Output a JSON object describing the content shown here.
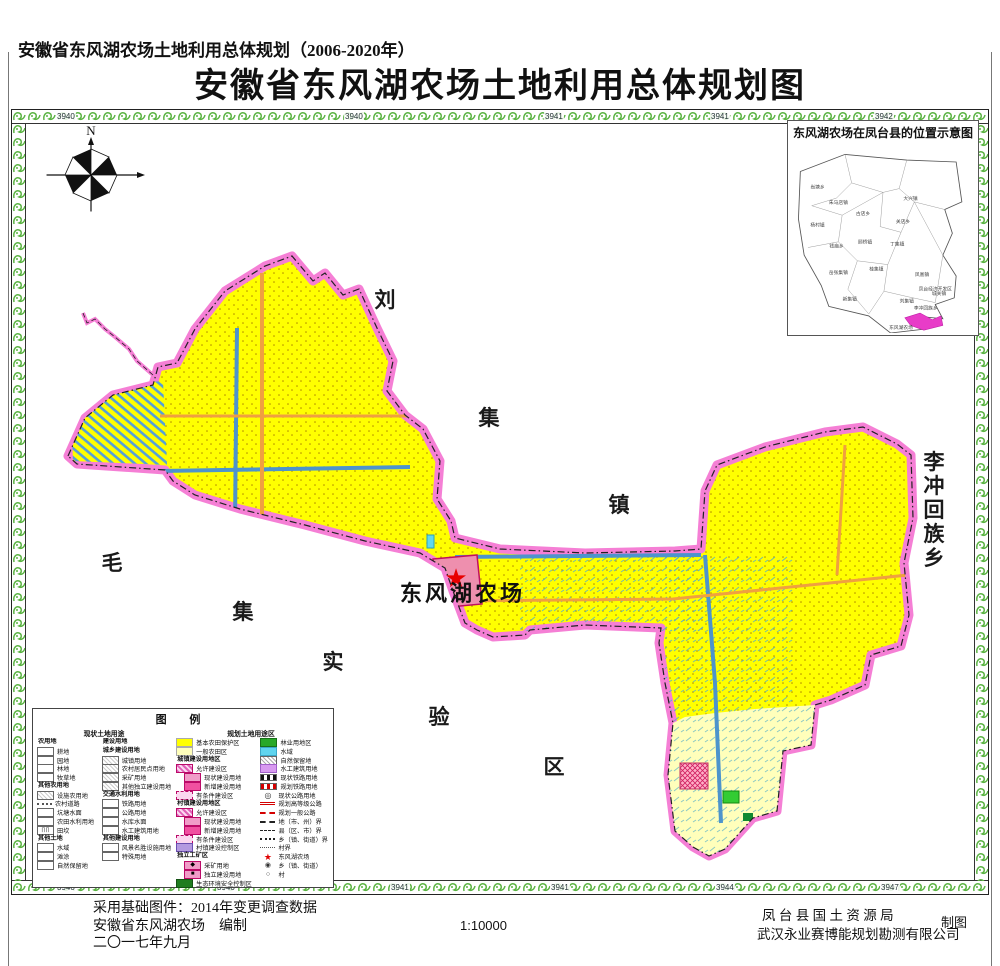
{
  "titles": {
    "subtitle": "安徽省东风湖农场土地利用总体规划（2006-2020年）",
    "title": "安徽省东风湖农场土地利用总体规划图"
  },
  "compass": {
    "north_label": "N"
  },
  "map": {
    "farm_label": "东风湖农场",
    "scatter_labels": [
      {
        "t": "刘",
        "x": 360,
        "y": 184
      },
      {
        "t": "集",
        "x": 464,
        "y": 302
      },
      {
        "t": "镇",
        "x": 594,
        "y": 389
      },
      {
        "t": "毛",
        "x": 87,
        "y": 447
      },
      {
        "t": "集",
        "x": 218,
        "y": 496
      },
      {
        "t": "实",
        "x": 308,
        "y": 546
      },
      {
        "t": "验",
        "x": 414,
        "y": 601
      },
      {
        "t": "区",
        "x": 529,
        "y": 651
      },
      {
        "t": "李",
        "x": 909,
        "y": 346,
        "s": 18
      },
      {
        "t": "冲",
        "x": 909,
        "y": 370,
        "s": 18
      },
      {
        "t": "回",
        "x": 909,
        "y": 394,
        "s": 18
      },
      {
        "t": "族",
        "x": 909,
        "y": 418,
        "s": 18
      },
      {
        "t": "乡",
        "x": 909,
        "y": 442,
        "s": 18
      }
    ],
    "grid_top": [
      {
        "v": "3940",
        "x": 44
      },
      {
        "v": "3940",
        "x": 332
      },
      {
        "v": "3941",
        "x": 532
      },
      {
        "v": "3941",
        "x": 698
      },
      {
        "v": "3942",
        "x": 862
      }
    ],
    "grid_bottom": [
      {
        "v": "3940",
        "x": 44
      },
      {
        "v": "3940",
        "x": 204
      },
      {
        "v": "3941",
        "x": 378
      },
      {
        "v": "3941",
        "x": 538
      },
      {
        "v": "3944",
        "x": 703
      },
      {
        "v": "3947",
        "x": 868
      }
    ]
  },
  "inset": {
    "title": "东风湖农场在凤台县的位置示意图",
    "farm_label": "东风湖农场",
    "towns": [
      {
        "t": "尚塘乡",
        "x": 26,
        "y": 48
      },
      {
        "t": "朱马店镇",
        "x": 48,
        "y": 64
      },
      {
        "t": "大兴镇",
        "x": 124,
        "y": 60
      },
      {
        "t": "古店乡",
        "x": 74,
        "y": 76
      },
      {
        "t": "杨村镇",
        "x": 26,
        "y": 88
      },
      {
        "t": "关店乡",
        "x": 116,
        "y": 84
      },
      {
        "t": "钱庙乡",
        "x": 46,
        "y": 110
      },
      {
        "t": "顾桥镇",
        "x": 76,
        "y": 106
      },
      {
        "t": "丁集镇",
        "x": 110,
        "y": 108
      },
      {
        "t": "岳张集镇",
        "x": 48,
        "y": 138
      },
      {
        "t": "桂集镇",
        "x": 88,
        "y": 134
      },
      {
        "t": "凤凰镇",
        "x": 136,
        "y": 140
      },
      {
        "t": "新集镇",
        "x": 60,
        "y": 166
      },
      {
        "t": "刘集镇",
        "x": 120,
        "y": 168
      },
      {
        "t": "凤台经济开发区",
        "x": 150,
        "y": 155,
        "s": 3.8
      },
      {
        "t": "城关镇",
        "x": 154,
        "y": 160,
        "s": 3.8
      },
      {
        "t": "李冲回族乡",
        "x": 140,
        "y": 175,
        "s": 4.2
      },
      {
        "t": "东风湖农场",
        "x": 114,
        "y": 196,
        "s": 4
      }
    ]
  },
  "legend": {
    "title": "图  例",
    "header_current": "现状土地用途",
    "header_planned": "规划土地用途区",
    "col1": [
      {
        "g": "农用地"
      },
      {
        "sw": "wb",
        "label": "耕地"
      },
      {
        "sw": "wb",
        "label": "园地"
      },
      {
        "sw": "wb",
        "label": "林地"
      },
      {
        "sw": "wb",
        "label": "牧草地"
      },
      {
        "g": "其他农用地"
      },
      {
        "sw": "wh",
        "label": "设施农用地"
      },
      {
        "sw": "ldot",
        "label": "农村道路"
      },
      {
        "sw": "wb",
        "label": "坑塘水面"
      },
      {
        "sw": "wb",
        "label": "农田水利用地"
      },
      {
        "sw": "tk",
        "label": "田坎"
      },
      {
        "g": "其他土地"
      },
      {
        "sw": "wb",
        "label": "水域"
      },
      {
        "sw": "wb",
        "label": "滩涂"
      },
      {
        "sw": "wb",
        "label": "自然保留地"
      }
    ],
    "col2": [
      {
        "g": "建设用地"
      },
      {
        "g": "城乡建设用地"
      },
      {
        "sw": "wh",
        "label": "城镇用地"
      },
      {
        "sw": "wh",
        "label": "农村居民点用地"
      },
      {
        "sw": "wh",
        "label": "采矿用地"
      },
      {
        "sw": "wh",
        "label": "其他独立建设用地"
      },
      {
        "g": "交通水利用地"
      },
      {
        "sw": "wb",
        "label": "铁路用地"
      },
      {
        "sw": "wb",
        "label": "公路用地"
      },
      {
        "sw": "wb",
        "label": "水库水面"
      },
      {
        "sw": "wb",
        "label": "水工建筑用地"
      },
      {
        "g": "其他建设用地"
      },
      {
        "sw": "wb",
        "label": "风景名胜设施用地"
      },
      {
        "sw": "wb",
        "label": "特殊用地"
      }
    ],
    "col3": [
      {
        "sw": "yl",
        "label": "基本农田保护区"
      },
      {
        "sw": "py",
        "label": "一般农田区"
      },
      {
        "g": "城镇建设用地区"
      },
      {
        "sw": "mh",
        "label": "允许建设区"
      },
      {
        "sw": "p1",
        "label": "现状建设用地",
        "ind": 1
      },
      {
        "sw": "p2",
        "label": "新增建设用地",
        "ind": 1
      },
      {
        "sw": "md",
        "label": "有条件建设区"
      },
      {
        "g": "村镇建设用地区"
      },
      {
        "sw": "mh",
        "label": "允许建设区"
      },
      {
        "sw": "p1",
        "label": "现状建设用地",
        "ind": 1
      },
      {
        "sw": "p2",
        "label": "新增建设用地",
        "ind": 1
      },
      {
        "sw": "md",
        "label": "有条件建设区"
      },
      {
        "sw": "vc",
        "label": "村镇建设控制区"
      },
      {
        "g": "独立工矿区"
      },
      {
        "sw": "m1",
        "label": "采矿用地",
        "ind": 1
      },
      {
        "sw": "m2",
        "label": "独立建设用地",
        "ind": 1
      },
      {
        "sw": "ec",
        "label": "生态环境安全控制区"
      }
    ],
    "col4": [
      {
        "sw": "gr",
        "label": "林业用地区"
      },
      {
        "sw": "cy",
        "label": "水域"
      },
      {
        "sw": "gh",
        "label": "自然保留地"
      },
      {
        "sw": "pu",
        "label": "水工建筑用地"
      },
      {
        "sw": "rn",
        "label": "现状铁路用地"
      },
      {
        "sw": "rp",
        "label": "规划铁路用地"
      },
      {
        "sw": "hn",
        "label": "现状公路用地"
      },
      {
        "sw": "hh",
        "label": "规划高等级公路"
      },
      {
        "sw": "hg",
        "label": "规划一般公路"
      },
      {
        "sw": "b1",
        "label": "地（市、州）界"
      },
      {
        "sw": "b2",
        "label": "县（区、市）界"
      },
      {
        "sw": "b3",
        "label": "乡（镇、街道）界"
      },
      {
        "sw": "b4",
        "label": "村界"
      },
      {
        "sw": "st",
        "label": "东风湖农场"
      },
      {
        "sw": "cd",
        "label": "乡（镇、街道）"
      },
      {
        "sw": "ci",
        "label": "村"
      }
    ]
  },
  "footer": {
    "line1": "采用基础图件：2014年变更调查数据",
    "line2": "安徽省东风湖农场　编制",
    "line3": "二〇一七年九月",
    "scale": "1:10000",
    "agency1": "凤 台 县 国 土 资 源 局",
    "agency2": "武汉永业赛博能规划勘测有限公司",
    "credit": "制图"
  },
  "colors": {
    "boundary_pink": "#f57fd5",
    "basic_farmland_yellow": "#ffff00",
    "general_farmland": "#ffffbb",
    "road_orange": "#f0a040",
    "canal_blue": "#4d94cc",
    "ornament_green": "#5bb343",
    "farm_site_red": "#e80000",
    "inset_highlight_magenta": "#e83cc8"
  }
}
